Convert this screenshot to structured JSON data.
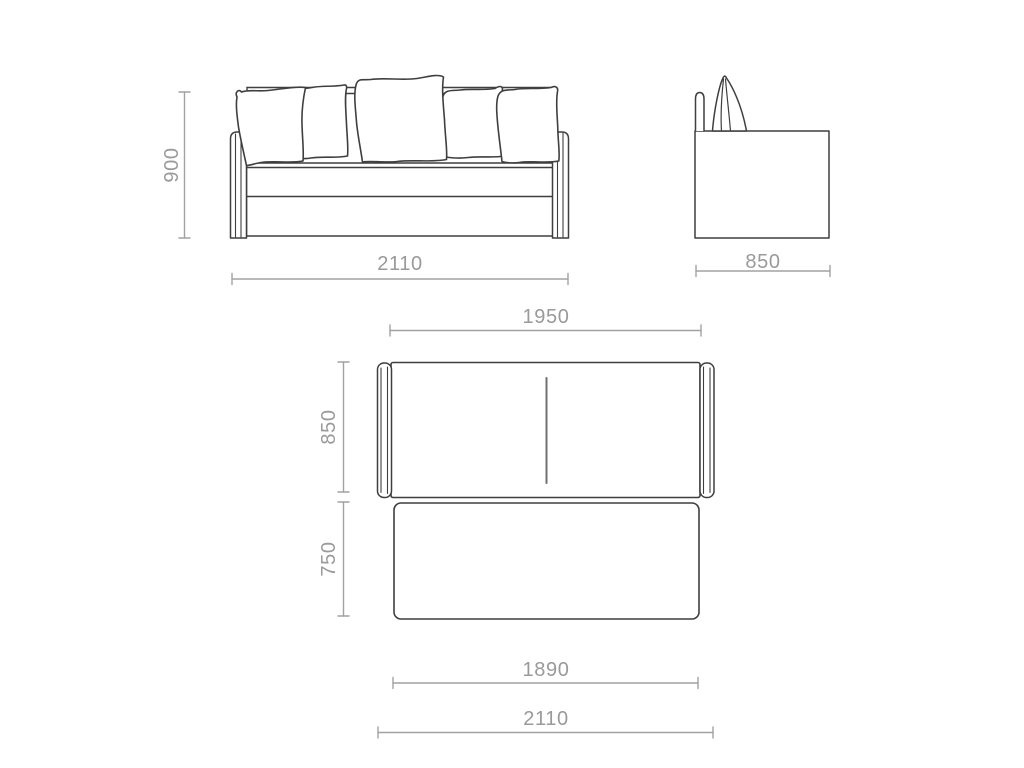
{
  "colors": {
    "background": "#ffffff",
    "object_line": "#3f3f3f",
    "dimension_line": "#a2a2a2",
    "dimension_text": "#9a9a9a"
  },
  "front_view": {
    "pillow_count": 5,
    "height_mm": "900",
    "width_mm": "2110"
  },
  "side_view": {
    "depth_mm": "850"
  },
  "top_view": {
    "upper_width_mm": "1950",
    "upper_depth_mm": "850",
    "lower_depth_mm": "750",
    "lower_width_mm": "1890",
    "overall_width_mm": "2110"
  }
}
